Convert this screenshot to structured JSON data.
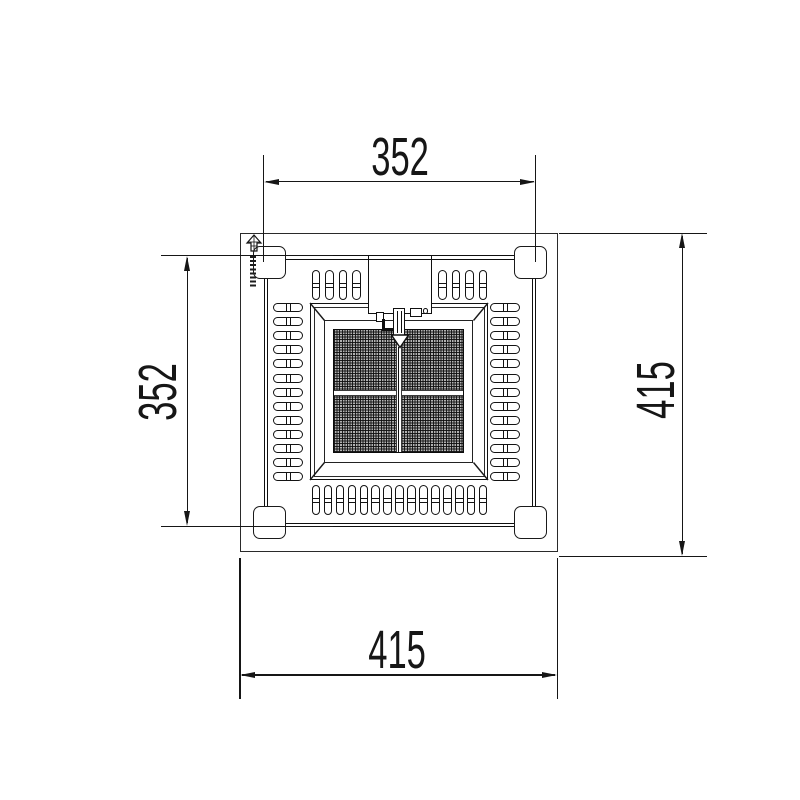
{
  "drawing": {
    "type": "technical-dimension-drawing",
    "view": "top view of square radiant gas heater",
    "background": "#ffffff",
    "line_color": "#141414",
    "dimensions": {
      "top": "352",
      "left": "352",
      "right": "415",
      "bottom": "415"
    },
    "vents": {
      "top_left": 4,
      "top_right": 4,
      "bottom": 15,
      "left": 13,
      "right": 13
    },
    "feet_count": 4,
    "emitter": {
      "grid_quadrants": 4
    },
    "icons": {
      "brand": "north-arrow-logo",
      "electrode": "igniter-electrode-arrow"
    }
  }
}
